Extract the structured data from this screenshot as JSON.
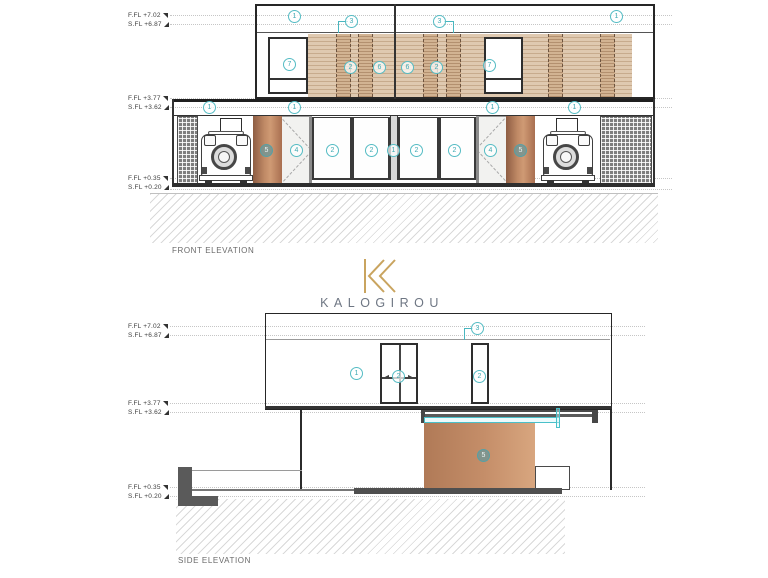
{
  "brand": {
    "name": "KALOGIROU"
  },
  "front": {
    "title": "FRONT ELEVATION",
    "levels": [
      {
        "ffl": "F.FL +7.02",
        "sfl": "S.FL +6.87"
      },
      {
        "ffl": "F.FL +3.77",
        "sfl": "S.FL +3.62"
      },
      {
        "ffl": "F.FL +0.35",
        "sfl": "S.FL +0.20"
      }
    ],
    "callouts": [
      {
        "n": "1",
        "x": 295,
        "y": 17
      },
      {
        "n": "3",
        "x": 352,
        "y": 22
      },
      {
        "n": "3",
        "x": 440,
        "y": 22
      },
      {
        "n": "1",
        "x": 617,
        "y": 17
      },
      {
        "n": "7",
        "x": 290,
        "y": 65
      },
      {
        "n": "2",
        "x": 351,
        "y": 68
      },
      {
        "n": "6",
        "x": 380,
        "y": 68
      },
      {
        "n": "6",
        "x": 408,
        "y": 68
      },
      {
        "n": "2",
        "x": 437,
        "y": 68
      },
      {
        "n": "7",
        "x": 490,
        "y": 66
      },
      {
        "n": "1",
        "x": 210,
        "y": 108
      },
      {
        "n": "1",
        "x": 295,
        "y": 108
      },
      {
        "n": "1",
        "x": 493,
        "y": 108
      },
      {
        "n": "1",
        "x": 575,
        "y": 108
      },
      {
        "n": "5",
        "x": 267,
        "y": 151,
        "filled": true
      },
      {
        "n": "4",
        "x": 297,
        "y": 151
      },
      {
        "n": "2",
        "x": 333,
        "y": 151
      },
      {
        "n": "2",
        "x": 372,
        "y": 151
      },
      {
        "n": "1",
        "x": 394,
        "y": 151
      },
      {
        "n": "2",
        "x": 417,
        "y": 151
      },
      {
        "n": "2",
        "x": 455,
        "y": 151
      },
      {
        "n": "4",
        "x": 491,
        "y": 151
      },
      {
        "n": "5",
        "x": 521,
        "y": 151,
        "filled": true
      }
    ]
  },
  "side": {
    "title": "SIDE ELEVATION",
    "levels": [
      {
        "ffl": "F.FL +7.02",
        "sfl": "S.FL +6.87"
      },
      {
        "ffl": "F.FL +3.77",
        "sfl": "S.FL +3.62"
      },
      {
        "ffl": "F.FL +0.35",
        "sfl": "S.FL +0.20"
      }
    ],
    "callouts": [
      {
        "n": "3",
        "x": 478,
        "y": 329
      },
      {
        "n": "1",
        "x": 357,
        "y": 374
      },
      {
        "n": "2",
        "x": 399,
        "y": 377,
        "arrows": true
      },
      {
        "n": "2",
        "x": 480,
        "y": 377
      },
      {
        "n": "5",
        "x": 484,
        "y": 456,
        "filled": true
      }
    ]
  },
  "colors": {
    "accent_teal": "#52bac3",
    "wood_louver": "#dcc5ac",
    "terracotta": "#bb835f",
    "logo_gold": "#c9a45f"
  }
}
